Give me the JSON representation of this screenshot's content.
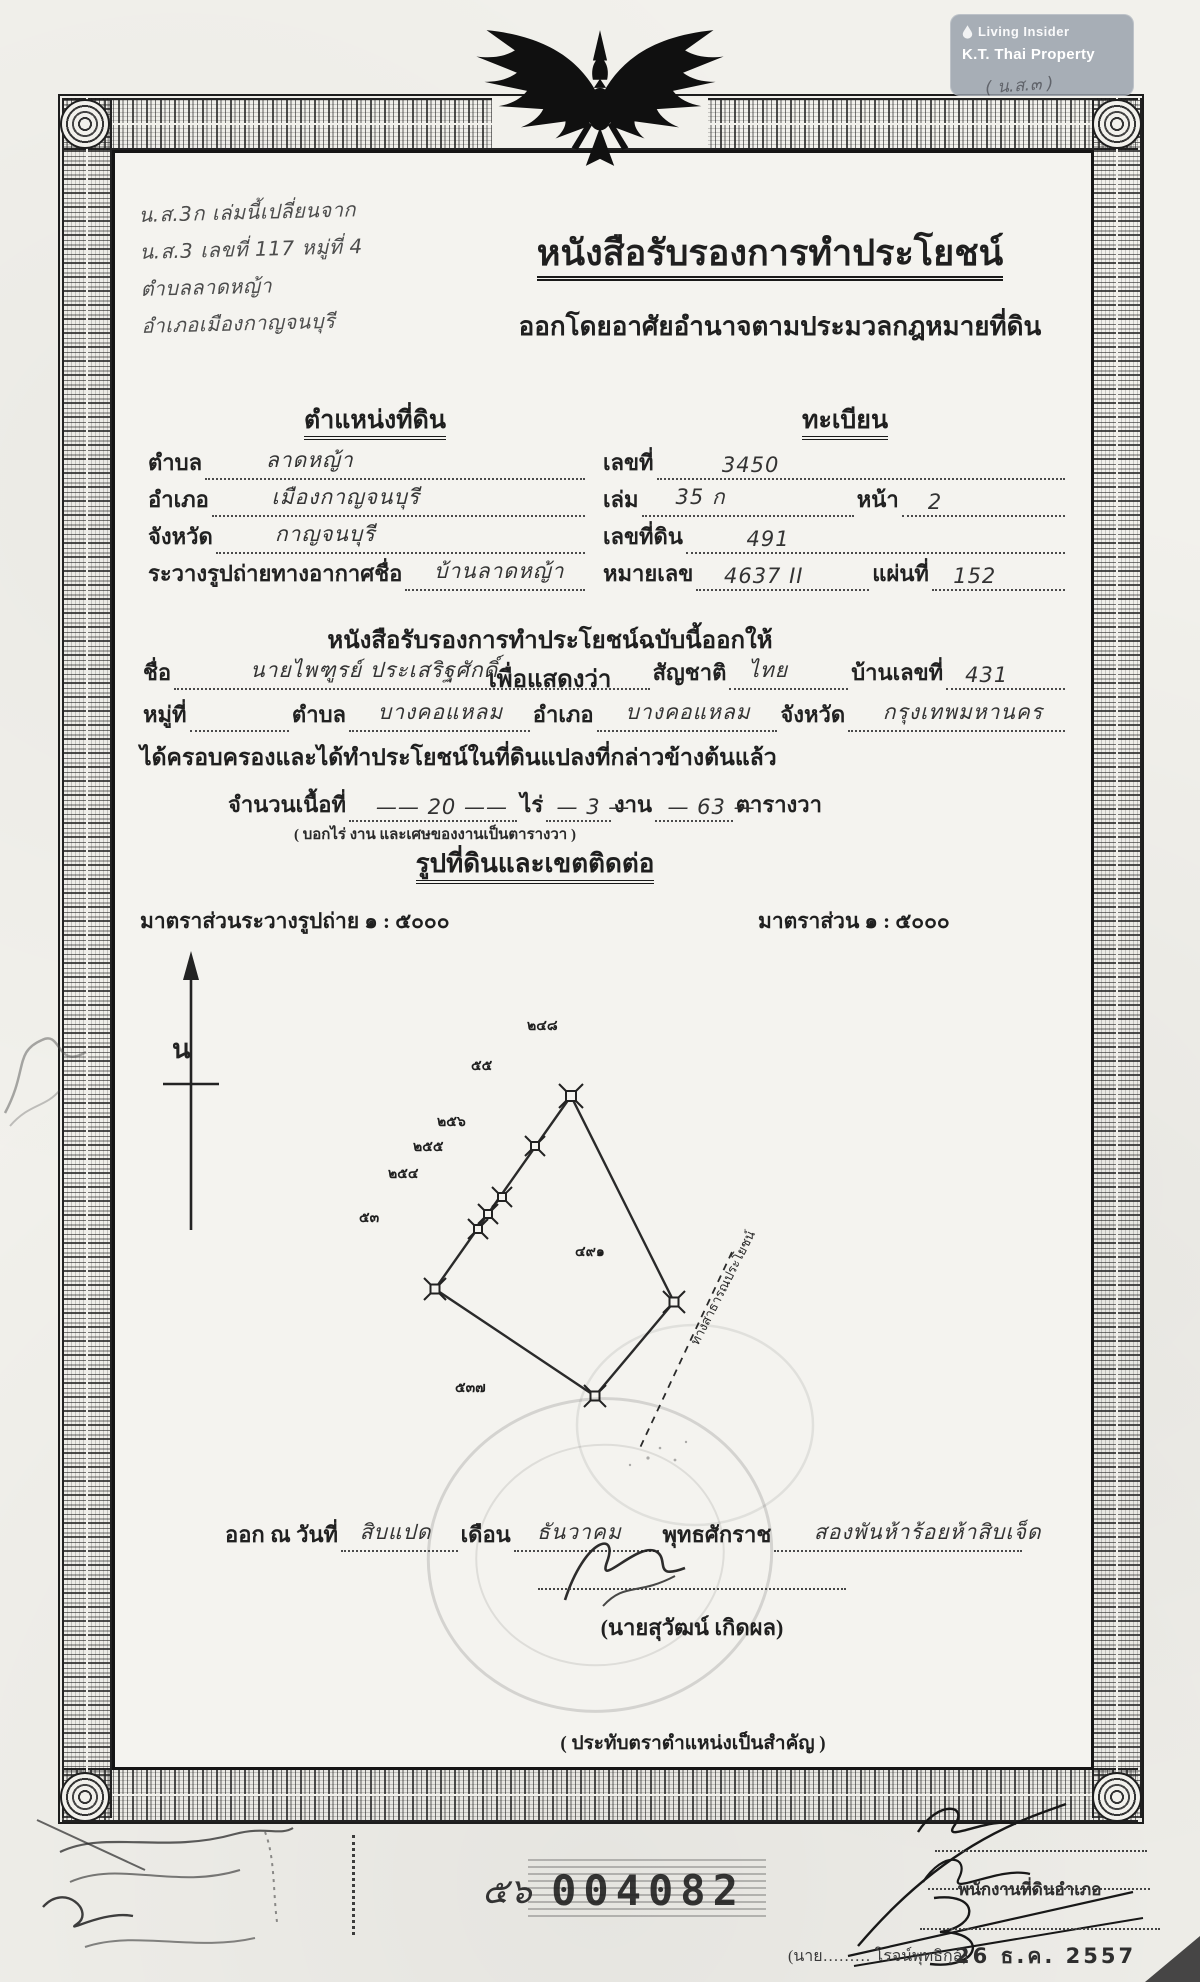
{
  "watermark": {
    "brand": "Living Insider",
    "subtitle": "K.T. Thai Property",
    "overlay_note": "( น.ส.๓ )"
  },
  "doc": {
    "corner_notes": [
      "น.ส.3ก เล่มนี้เปลี่ยนจาก",
      "น.ส.3 เลขที่ 117 หมู่ที่ 4",
      "ตำบลลาดหญ้า",
      "อำเภอเมืองกาญจนบุรี"
    ],
    "title": "หนังสือรับรองการทำประโยชน์",
    "subtitle": "ออกโดยอาศัยอำนาจตามประมวลกฎหมายที่ดิน"
  },
  "location": {
    "heading": "ตำแหน่งที่ดิน",
    "tambon_label": "ตำบล",
    "tambon": "ลาดหญ้า",
    "amphoe_label": "อำเภอ",
    "amphoe": "เมืองกาญจนบุรี",
    "changwat_label": "จังหวัด",
    "changwat": "กาญจนบุรี",
    "rawang_label": "ระวางรูปถ่ายทางอากาศชื่อ",
    "rawang": "บ้านลาดหญ้า"
  },
  "register": {
    "heading": "ทะเบียน",
    "lek_label": "เลขที่",
    "lek": "3450",
    "lem_label": "เล่ม",
    "lem": "35 ก",
    "na_label": "หน้า",
    "na": "2",
    "lekthidin_label": "เลขที่ดิน",
    "lekthidin": "491",
    "mailek_label": "หมายเลข",
    "mailek": "4637 II",
    "phaen_label": "แผ่นที่",
    "phaen": "152"
  },
  "owner": {
    "heading": "หนังสือรับรองการทำประโยชน์ฉบับนี้ออกให้เพื่อแสดงว่า",
    "name_label": "ชื่อ",
    "name": "นายไพฑูรย์ ประเสริฐศักดิ์",
    "nationality_label": "สัญชาติ",
    "nationality": "ไทย",
    "house_label": "บ้านเลขที่",
    "house": "431",
    "moo_label": "หมู่ที่",
    "moo": "",
    "tambon_label": "ตำบล",
    "tambon": "บางคอแหลม",
    "amphoe_label": "อำเภอ",
    "amphoe": "บางคอแหลม",
    "changwat_label": "จังหวัด",
    "changwat": "กรุงเทพมหานคร",
    "possession": "ได้ครอบครองและได้ทำประโยชน์ในที่ดินแปลงที่กล่าวข้างต้นแล้ว"
  },
  "area": {
    "label": "จำนวนเนื้อที่",
    "rai": "20",
    "rai_label": "ไร่",
    "ngan": "3",
    "ngan_label": "งาน",
    "wa": "63",
    "wa_label": "ตารางวา",
    "note": "( บอกไร่ งาน และเศษของงานเป็นตารางวา )"
  },
  "map": {
    "heading": "รูปที่ดินและเขตติดต่อ",
    "scale_left": "มาตราส่วนระวางรูปถ่าย ๑ : ๕๐๐๐",
    "scale_right": "มาตราส่วน ๑ : ๕๐๐๐",
    "north_label": "น",
    "parcel_number": "๔๙๑",
    "adjacent_parcels": [
      "๒๔๘",
      "๕๕",
      "๒๕๖",
      "๒๕๕",
      "๒๕๔",
      "๕๓",
      "๕๓๗"
    ],
    "road_label": "ทางสาธารณประโยชน์"
  },
  "issue": {
    "prefix": "ออก ณ วันที่",
    "day": "สิบแปด",
    "month_label": "เดือน",
    "month": "ธันวาคม",
    "era_label": "พุทธศักราช",
    "year": "สองพันห้าร้อยห้าสิบเจ็ด",
    "signer_name": "(นายสุวัฒน์ เกิดผล)",
    "seal_note": "( ประทับตราตำแหน่งเป็นสำคัญ )"
  },
  "footer": {
    "serial_prefix": "๕๖",
    "serial": "004082",
    "official_title": "พนักงานที่ดินอำเภอ",
    "official_name": "(นาย……… โรจน์พุทธิกุล)",
    "date_stamp": "26 ธ.ค. 2557"
  }
}
